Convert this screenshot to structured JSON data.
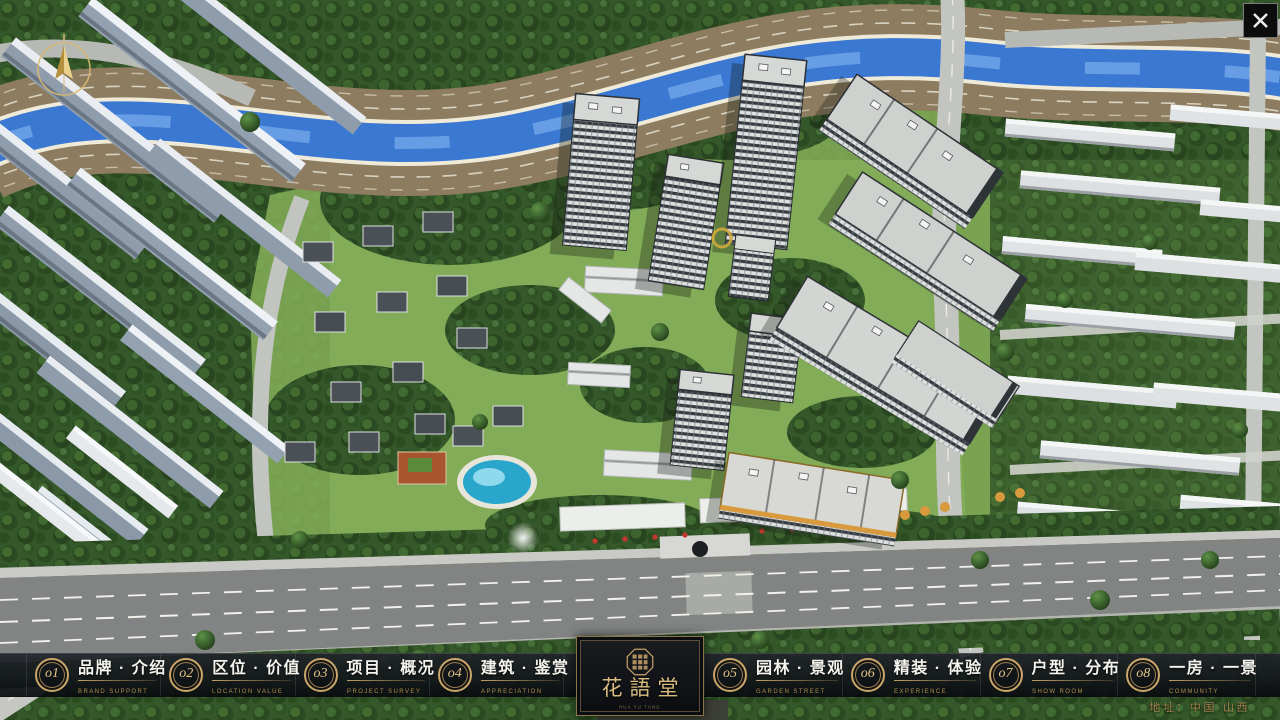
{
  "colors": {
    "gold": "#c9a66b",
    "gold_bright": "#e2c487",
    "bar_bg": "rgba(12,14,18,0.9)",
    "title_text": "#f4f3ee",
    "subtitle_text": "#b08f52",
    "river_blue": "#3a78d2",
    "accent_red": "#c23830"
  },
  "hud": {
    "close_icon": "close-icon",
    "compass_icon": "compass-north-icon"
  },
  "menu": {
    "items": [
      {
        "num": "o1",
        "title": "品牌 · 介绍",
        "subtitle": "BRAND SUPPORT"
      },
      {
        "num": "o2",
        "title": "区位 · 价值",
        "subtitle": "LOCATION VALUE"
      },
      {
        "num": "o3",
        "title": "项目 · 概况",
        "subtitle": "PROJECT SURVEY"
      },
      {
        "num": "o4",
        "title": "建筑 · 鉴赏",
        "subtitle": "APPRECIATION"
      },
      {
        "num": "o5",
        "title": "园林 · 景观",
        "subtitle": "GARDEN STREET"
      },
      {
        "num": "o6",
        "title": "精装 · 体验",
        "subtitle": "EXPERIENCE"
      },
      {
        "num": "o7",
        "title": "户型 · 分布",
        "subtitle": "SHOW ROOM"
      },
      {
        "num": "o8",
        "title": "一房 · 一景",
        "subtitle": "COMMUNITY"
      }
    ]
  },
  "logo": {
    "name": "花語堂",
    "subtitle": "HUA YU TANG",
    "seal_icon": "seal-icon"
  },
  "footer": {
    "address": "地址：中国·山西"
  }
}
